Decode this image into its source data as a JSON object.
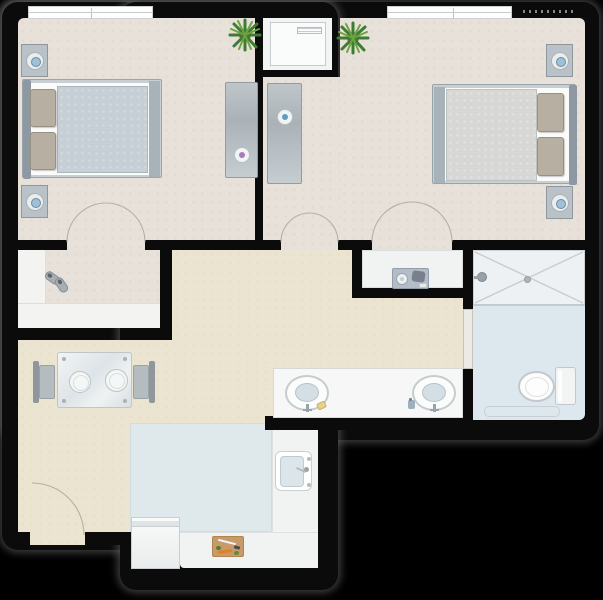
{
  "scene": {
    "type": "architectural-floor-plan",
    "description": "Top-down floor plan of a two-bedroom apartment with central hallway, double vanity, bathroom with walk-in shower and toilet, kitchen and dining nook",
    "background": "#000000"
  },
  "colors": {
    "wall": "#0b0b0b",
    "outline_glow": "rgba(110,110,110,0.55)",
    "floor_bedroom": "#e7e1d9",
    "floor_hall": "#ebe4d1",
    "floor_closet_shelf": "#f3f4f2",
    "floor_bath": "#dde8ee",
    "floor_shower": "#edf1f3",
    "floor_kitchen": "#dfe9ec",
    "counter_white": "#f1f3f3",
    "appliance_white": "#fafbfb",
    "furniture_gray": "#b9c2c8",
    "furniture_gray_dark": "#8d98a2",
    "bed_duvet_blue": "#c5cfd5",
    "bed_duvet_gray": "#d7d8d5",
    "pillow_khaki": "#b6afa2",
    "knob_purple": "#a87cb8",
    "knob_blue": "#5f9fc4",
    "lamp_blue": "#9fc0d6",
    "plant_green": "#3c7c33",
    "plant_green_light": "#6fa33f",
    "pot_brown": "#8a5a3b",
    "tray_gray": "#b3bdc7",
    "board_tan": "#c79a6a",
    "carrot_orange": "#e07f28",
    "soap_yellow": "#e8d089",
    "window_white": "#fdfdfd",
    "arc_line": "#b5afa5"
  },
  "rooms": [
    {
      "id": "bedroom-1",
      "position": "top-left",
      "fixtures": [
        "double-bed",
        "two-nightstands",
        "two-table-lamps",
        "dresser",
        "potted-plant",
        "window",
        "double-door"
      ]
    },
    {
      "id": "bedroom-2",
      "position": "top-right",
      "fixtures": [
        "double-bed",
        "two-nightstands",
        "two-table-lamps",
        "dresser",
        "potted-plant",
        "window",
        "double-door"
      ]
    },
    {
      "id": "utility-closet",
      "position": "top-center",
      "fixtures": [
        "washer"
      ]
    },
    {
      "id": "walk-in-closet",
      "position": "mid-left",
      "fixtures": [
        "shelving",
        "pair-of-shoes"
      ]
    },
    {
      "id": "hallway",
      "position": "center",
      "fixtures": [
        "double-vanity",
        "two-sinks",
        "soap",
        "coffee-niche",
        "coffee-tray"
      ]
    },
    {
      "id": "bathroom",
      "position": "right",
      "fixtures": [
        "walk-in-shower",
        "shower-head",
        "floor-drain",
        "pocket-door",
        "toilet",
        "bath-mat"
      ]
    },
    {
      "id": "kitchen",
      "position": "bottom-center",
      "fixtures": [
        "island-floor",
        "l-shaped-counter",
        "kitchen-sink",
        "dishwasher",
        "cutting-board"
      ]
    },
    {
      "id": "dining-area",
      "position": "bottom-left",
      "fixtures": [
        "glass-table",
        "two-chairs",
        "two-plates",
        "entry-door"
      ]
    }
  ],
  "doors": {
    "bedroom_1_double_door": "bottom wall of bedroom 1",
    "bedroom_2_double_door": "bottom wall of bedroom 2",
    "hall_double_door": "between dresser corridor and hallway",
    "entry_door": "bottom wall of dining area",
    "bathroom_pocket_door": "left bathroom wall"
  }
}
